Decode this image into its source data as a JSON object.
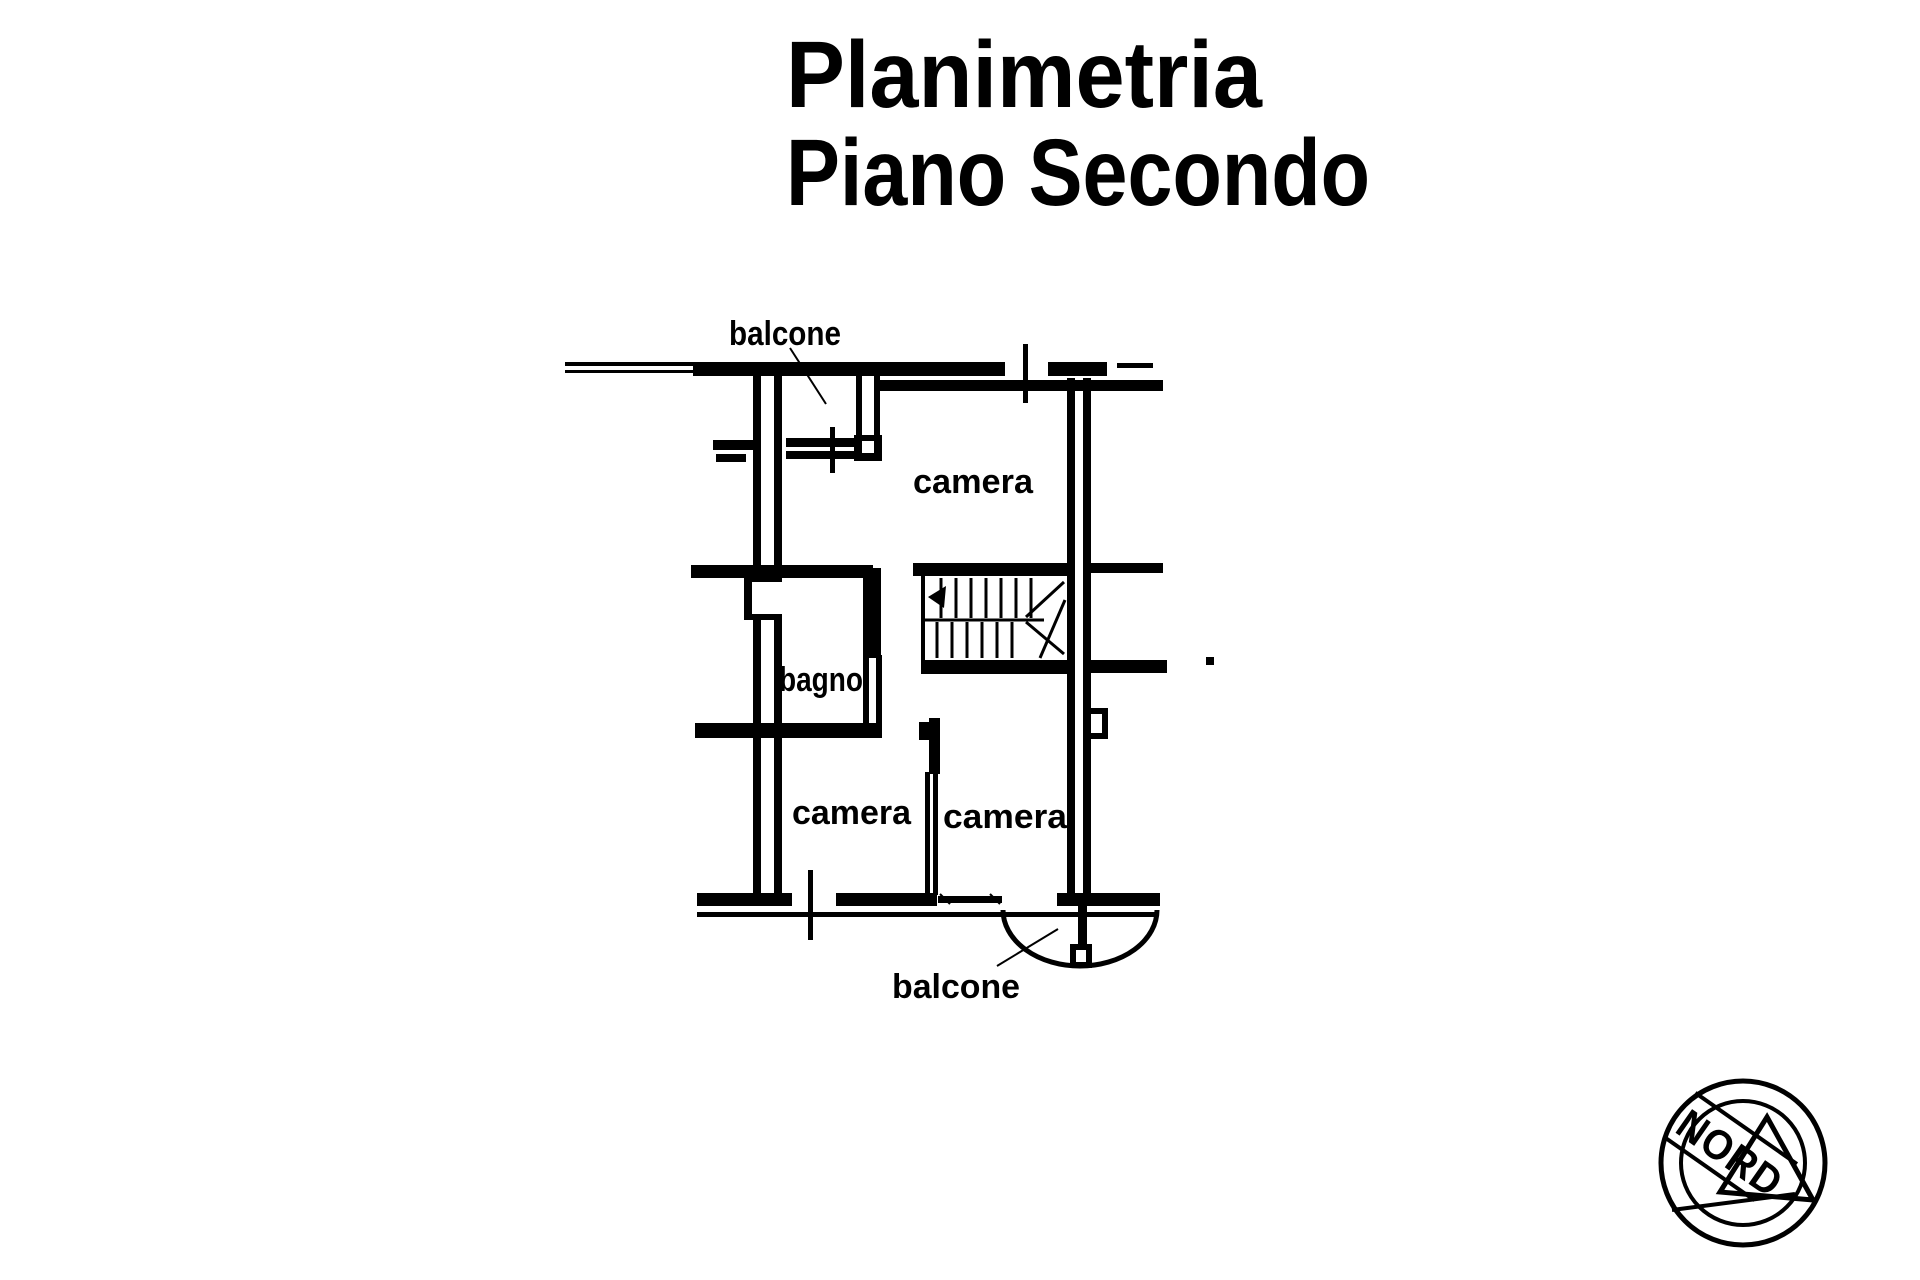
{
  "page": {
    "background": "#ffffff",
    "ink": "#000000"
  },
  "title": {
    "line1": "Planimetria",
    "line2": "Piano Secondo"
  },
  "floor_plan": {
    "labels": {
      "balcone_top": "balcone",
      "camera_top": "camera",
      "bagno": "bagno",
      "camera_bottom_left": "camera",
      "camera_bottom_right": "camera",
      "balcone_bottom": "balcone"
    }
  },
  "compass": {
    "label": "NORD"
  }
}
